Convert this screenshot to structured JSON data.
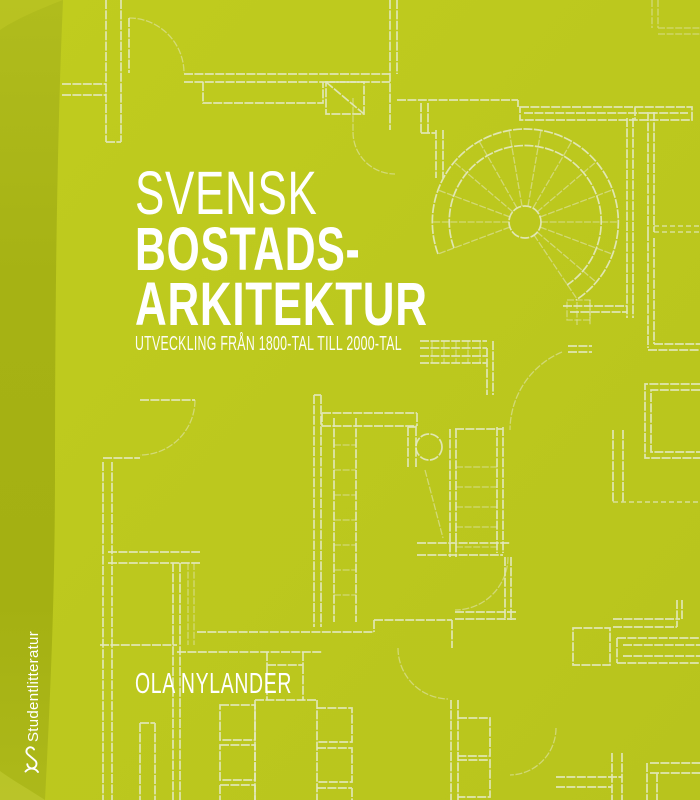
{
  "cover": {
    "title": {
      "line1": "SVENSK",
      "line2": "BOSTADS-",
      "line3": "ARKITEKTUR"
    },
    "subtitle": "UTVECKLING FRÅN 1800-TAL TILL 2000-TAL",
    "author": "OLA NYLANDER",
    "publisher": {
      "name": "Studentlitteratur"
    },
    "colors": {
      "background": "#bcc81d",
      "spine": "#a6b214",
      "plan_lines": "#e3e8bf",
      "text": "#ffffff"
    }
  }
}
